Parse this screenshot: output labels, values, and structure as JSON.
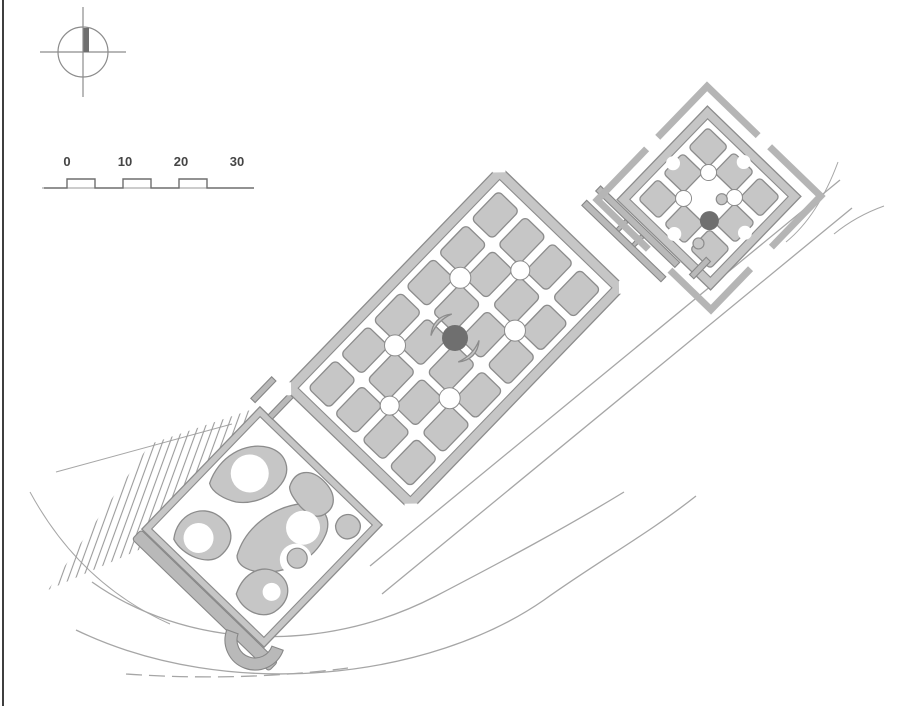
{
  "title": "Terraced parterre garden plan",
  "colors": {
    "page_bg": "#ffffff",
    "bed_fill": "#c6c6c6",
    "bed_stroke": "#8c8c8c",
    "hedge_fill": "#b9b9b9",
    "hedge_stroke": "#878787",
    "pool_fill": "#6f6f6f",
    "road_stroke": "#a6a6a6",
    "hatch_stroke": "#9b9b9b",
    "border_color": "#3f3f3f",
    "label_color": "#454545"
  },
  "compass": {
    "symbol": "crosshair-circle-north-indicator"
  },
  "scale_bar": {
    "labels": [
      "0",
      "10",
      "20",
      "30"
    ]
  },
  "plan": {
    "terraces": [
      {
        "name": "lower-terrace",
        "style": "scroll-parterre",
        "features": [
          "fountain-basin",
          "semicircular-exedra",
          "retaining-wall",
          "hatched-slope"
        ]
      },
      {
        "name": "middle-terrace",
        "style": "quartered-parterre",
        "bed_count": 24,
        "features": [
          "central-dark-pool",
          "four-rond-points",
          "end-rond-points"
        ]
      },
      {
        "name": "upper-terrace",
        "style": "scalloped-parterre",
        "features": [
          "dark-pool",
          "two-small-basins",
          "detached-corner-hedges"
        ]
      }
    ],
    "roads": [
      "curved-lower-road",
      "straight-upper-road",
      "dashed-track",
      "connector-paths"
    ]
  }
}
